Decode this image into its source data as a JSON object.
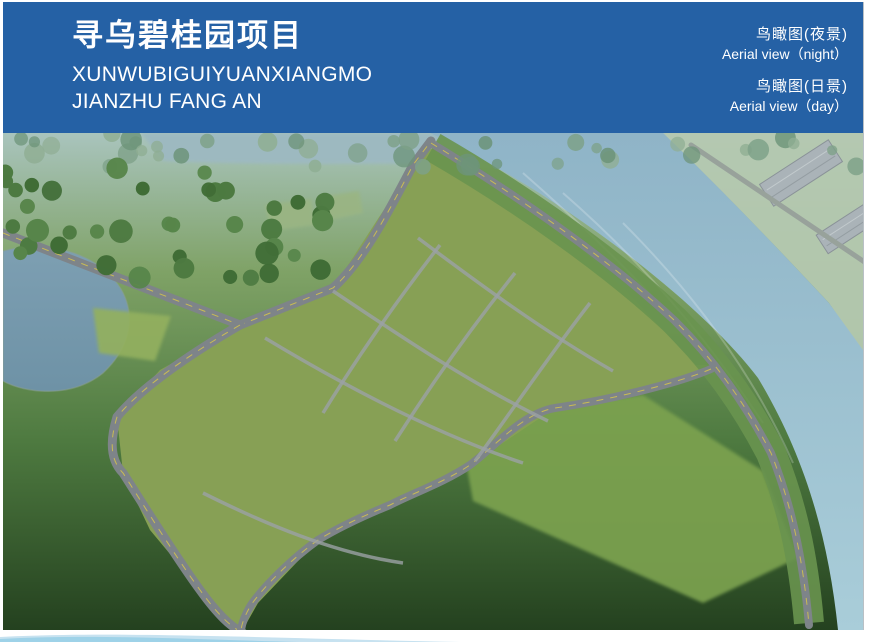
{
  "header": {
    "bg": "#2561a5",
    "title_cn": "寻乌碧桂园项目",
    "subtitle_line1": "XUNWUBIGUIYUANXIANGMO",
    "subtitle_line2": "JIANZHU FANG AN",
    "labels": [
      {
        "cn": "鸟瞰图(夜景)",
        "en": "Aerial view（night）"
      },
      {
        "cn": "鸟瞰图(日景)",
        "en": "Aerial view（day）"
      }
    ]
  },
  "scene": {
    "w": 860,
    "h": 497,
    "palettes": {
      "haze": [
        "#7ea188",
        "#8fae93",
        "#6d9479"
      ],
      "forest": [
        "#4d7a41",
        "#406d36",
        "#57854a"
      ],
      "forestDark": [
        "#3f6b35",
        "#35602c",
        "#4a7a3e"
      ],
      "deep": [
        "#28421f",
        "#1f3519",
        "#32512a"
      ],
      "deep2": [
        "#233c1c",
        "#1b3015",
        "#2f4f28"
      ],
      "lawnTrees": [
        "#3c6630",
        "#47743a"
      ],
      "bank": [
        "#4c7a47",
        "#5b8a53"
      ],
      "farRoad": [
        "#5c8556",
        "#6b9463"
      ],
      "site": [
        "#5f9040",
        "#70a24c",
        "#548538"
      ],
      "garden": [
        "#d98f35",
        "#d9c33f",
        "#cf8fc0",
        "#c05038",
        "#9bc15a",
        "#b66fb0"
      ],
      "car": [
        "#e9ebec",
        "#343b42",
        "#b9bec3",
        "#b23a30"
      ]
    },
    "base": {
      "top": "#a9c4bd",
      "mid": "#7fa266",
      "low": "#4e7a40",
      "bottom": "#24411f"
    },
    "farFields": {
      "d": "M660,0 L873,0 L873,238 L826,170 C770,110 710,48 660,0 Z",
      "fill": "#b4c8b0"
    },
    "warehouses": [
      [
        798,
        40,
        82,
        26,
        -33
      ],
      [
        846,
        94,
        64,
        22,
        -33
      ]
    ],
    "topWater": {
      "d": "M138,0 L662,0 L648,24 C500,30 300,34 160,28 Z",
      "fill": "#9db9c1"
    },
    "river": {
      "d": "M427,0 L660,0 C710,48 770,110 826,170 L873,235 L873,497 L835,497 C825,400 800,320 755,245 C700,172 560,62 427,0 Z"
    },
    "streaks": [
      "M520,40 C600,110 680,190 740,270",
      "M560,60 C640,130 700,200 760,290",
      "M620,90 C690,160 750,240 790,330"
    ],
    "bankStrip": {
      "d": "M430,14 C520,66 610,130 672,188 C712,228 742,270 768,320 C788,370 800,420 806,490",
      "w": 30,
      "c": "#69944f"
    },
    "lake": {
      "d": "M0,118 C45,106 96,120 118,156 C133,182 128,214 100,240 C68,266 22,260 0,248 Z"
    },
    "lawns": [
      {
        "d": "M90,175 L168,183 L152,228 L96,220 Z",
        "c": "#93b05e"
      },
      {
        "d": "M262,72 L308,66 L312,92 L268,98 Z",
        "c": "#9ab583"
      },
      {
        "d": "M318,64 L356,58 L360,80 L322,88 Z",
        "c": "#9ab583"
      },
      {
        "d": "M455,285 L640,262 L760,338 L795,425 L700,470 L470,368 Z",
        "c": "#7ca24f"
      }
    ],
    "site": {
      "pts": "237,192 330,155 410,32 430,14 490,50 557,96 625,160 693,232 708,232 693,245 637,262 552,275 467,332 387,372 315,407 255,470 238,500 197,457 147,397 120,340 114,284 157,237",
      "fill": "#87a055"
    },
    "roads": [
      {
        "d": "M0,100 L237,192 L330,155 C360,128 385,80 410,32 L428,8",
        "w": 9,
        "dash": true
      },
      {
        "d": "M237,192 C180,225 135,258 114,284 C106,310 108,328 120,340 C138,368 170,420 197,457 C215,482 228,494 240,500",
        "w": 9,
        "dash": true
      },
      {
        "d": "M708,236 C670,252 600,268 552,275 C520,280 490,315 467,332 C440,350 410,360 387,372 C355,385 335,395 315,407 C290,425 262,452 248,472 C242,482 239,490 238,497",
        "w": 8,
        "dash": true
      },
      {
        "d": "M428,10 C520,66 610,130 672,188 C712,228 742,270 768,320 C788,370 800,425 806,492",
        "w": 8,
        "dash": true
      },
      {
        "d": "M688,12 L866,132",
        "w": 5,
        "dash": false,
        "c": "#98a29b"
      }
    ],
    "lanes": [
      "M262,205 C340,252 430,300 520,330",
      "M330,158 C400,205 470,252 545,288",
      "M415,105 C475,150 540,198 610,238",
      "M437,112 C392,170 352,228 320,280",
      "M512,140 C464,200 424,258 392,308",
      "M587,170 C542,228 502,288 472,328",
      "M200,360 C260,390 330,420 400,430"
    ],
    "buildings": [
      [
        145,
        312,
        62,
        13
      ],
      [
        183,
        356,
        66,
        14
      ],
      [
        192,
        270,
        80,
        13
      ],
      [
        228,
        332,
        66,
        13
      ],
      [
        242,
        358,
        72,
        14
      ],
      [
        367,
        143,
        50,
        12
      ],
      [
        327,
        193,
        50,
        12
      ],
      [
        287,
        243,
        50,
        13
      ],
      [
        427,
        122,
        52,
        12
      ],
      [
        387,
        172,
        52,
        12
      ],
      [
        347,
        222,
        52,
        13
      ],
      [
        307,
        272,
        52,
        13
      ],
      [
        495,
        135,
        52,
        12
      ],
      [
        455,
        185,
        52,
        12
      ],
      [
        415,
        235,
        52,
        13
      ],
      [
        370,
        290,
        52,
        14
      ],
      [
        575,
        155,
        52,
        12
      ],
      [
        535,
        205,
        52,
        13
      ],
      [
        495,
        255,
        52,
        13
      ],
      [
        452,
        305,
        60,
        16
      ],
      [
        645,
        180,
        50,
        12
      ],
      [
        605,
        230,
        52,
        13
      ],
      [
        565,
        280,
        55,
        14
      ],
      [
        500,
        100,
        46,
        10
      ],
      [
        553,
        123,
        46,
        10
      ],
      [
        611,
        151,
        46,
        10
      ],
      [
        669,
        181,
        44,
        10
      ],
      [
        302,
        360,
        95,
        15
      ],
      [
        387,
        322,
        85,
        15
      ],
      [
        339,
        395,
        55,
        14
      ]
    ],
    "tower": [
      447,
      68,
      42,
      44,
      20
    ],
    "pool": [
      516,
      74
    ],
    "plaza": [
      377,
      268
    ],
    "gardens": [
      [
        552,
        222
      ],
      [
        550,
        163
      ],
      [
        472,
        162
      ],
      [
        424,
        302
      ],
      [
        330,
        230
      ],
      [
        253,
        328
      ],
      [
        610,
        207
      ],
      [
        520,
        332
      ],
      [
        362,
        160
      ],
      [
        432,
        256
      ],
      [
        581,
        336
      ],
      [
        290,
        300
      ]
    ],
    "clusters": [
      [
        "r",
        0,
        0,
        860,
        34,
        40,
        5,
        11,
        "haze",
        0.8
      ],
      [
        "r",
        0,
        30,
        330,
        115,
        40,
        6,
        12,
        "forest",
        1
      ],
      [
        "l",
        5,
        112,
        235,
        192,
        20,
        10,
        5,
        9,
        "forestDark",
        1
      ],
      [
        "r",
        0,
        238,
        165,
        92,
        24,
        5,
        10,
        "forestDark",
        1
      ],
      [
        "r",
        0,
        340,
        245,
        152,
        38,
        7,
        13,
        "deep",
        1
      ],
      [
        "r",
        222,
        392,
        575,
        102,
        55,
        7,
        13,
        "deep2",
        1
      ],
      [
        "r",
        455,
        282,
        330,
        150,
        26,
        5,
        9,
        "lawnTrees",
        1
      ],
      [
        "l",
        228,
        180,
        398,
        28,
        18,
        9,
        4,
        8,
        "forestDark",
        1
      ],
      [
        "l",
        255,
        198,
        425,
        48,
        12,
        6,
        3,
        5,
        "forestDark",
        1
      ],
      [
        "l",
        100,
        330,
        235,
        495,
        15,
        9,
        5,
        9,
        "forestDark",
        1
      ],
      [
        "l",
        5,
        90,
        235,
        178,
        16,
        8,
        4,
        8,
        "forest",
        1
      ],
      [
        "l",
        437,
        16,
        808,
        382,
        38,
        14,
        5,
        10,
        "forestDark",
        1
      ],
      [
        "l",
        665,
        8,
        866,
        240,
        28,
        11,
        4,
        8,
        "bank",
        0.95
      ],
      [
        "l",
        690,
        16,
        864,
        130,
        22,
        6,
        3,
        6,
        "farRoad",
        0.9
      ],
      [
        "r",
        258,
        140,
        400,
        215,
        55,
        2.5,
        5,
        "site",
        1
      ]
    ],
    "cars": [
      [
        337,
        132,
        -22,
        1
      ],
      [
        354,
        99,
        -57,
        0
      ],
      [
        387,
        59,
        -57,
        2
      ],
      [
        270,
        170,
        -22,
        0
      ],
      [
        80,
        122,
        21,
        0
      ],
      [
        150,
        152,
        21,
        1
      ],
      [
        135,
        368,
        57,
        0
      ],
      [
        175,
        432,
        57,
        2
      ],
      [
        215,
        478,
        57,
        0
      ],
      [
        505,
        300,
        146,
        0
      ],
      [
        470,
        325,
        146,
        1
      ],
      [
        430,
        352,
        146,
        3
      ],
      [
        560,
        272,
        146,
        2
      ],
      [
        560,
        100,
        42,
        0
      ],
      [
        625,
        148,
        44,
        1
      ],
      [
        680,
        195,
        46,
        0
      ],
      [
        718,
        258,
        58,
        2
      ]
    ],
    "parkRows": [
      [
        185,
        350,
        11,
        3,
        5,
        60
      ],
      [
        540,
        297,
        12,
        4.5,
        5,
        55
      ],
      [
        700,
        255,
        11,
        7,
        4,
        55
      ]
    ],
    "boats": [
      [
        232,
        16
      ],
      [
        284,
        12
      ],
      [
        360,
        17
      ],
      [
        518,
        8
      ],
      [
        578,
        5
      ],
      [
        640,
        10
      ]
    ],
    "mist": [
      [
        760,
        420,
        95,
        48,
        0.75
      ],
      [
        845,
        365,
        70,
        42,
        0.65
      ],
      [
        690,
        468,
        85,
        36,
        0.6
      ],
      [
        848,
        62,
        55,
        32,
        0.5
      ],
      [
        640,
        18,
        70,
        16,
        0.3
      ],
      [
        820,
        250,
        60,
        30,
        0.35
      ]
    ],
    "colors": {
      "roof": "#3a444e",
      "roofStroke": "#2b333b",
      "ridge": "#687582",
      "eave": "#9aa5ae",
      "facade": "#e7e9e9",
      "stripe": "#3a414b",
      "endFace": "#c3c7ca",
      "endStripe": "#8b9097",
      "shadow": "rgba(22,32,20,0.35)",
      "road": "#7e8489",
      "roadLine": "#d6c54b",
      "lane": "#9ba1a5",
      "lakeTop": "#7d9fb2",
      "lakeBot": "#6e92a6",
      "riverTop": "#8fb4c7",
      "riverBot": "#a9cdd9",
      "poolDeck": "#c9b489",
      "pool": "#3d84c4",
      "pool2": "#64a3d3",
      "plaza": "#b28e5c",
      "plazaIn": "#d2b984",
      "warehouse": "#aab3b8",
      "warehouseEdge": "#8a9298",
      "mist": "#ffffff"
    }
  }
}
